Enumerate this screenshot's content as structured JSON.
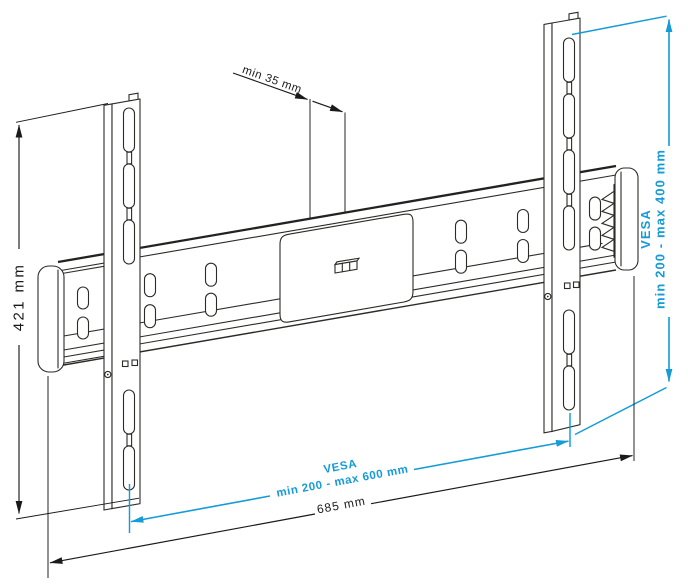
{
  "drawing": {
    "title": "wall-mount-technical-drawing",
    "annotations": {
      "depth": "min 35 mm",
      "height": "421 mm",
      "vesa_vertical_title": "VESA",
      "vesa_vertical_range": "min 200 - max 400 mm",
      "vesa_horizontal_title": "VESA",
      "vesa_horizontal_range": "min 200 - max 600 mm",
      "width": "685 mm"
    },
    "colors": {
      "dimension_accent": "#149bd8",
      "dimension_line": "#1a1a1a",
      "drawing_line": "#2b2b27",
      "background": "#ffffff"
    }
  }
}
